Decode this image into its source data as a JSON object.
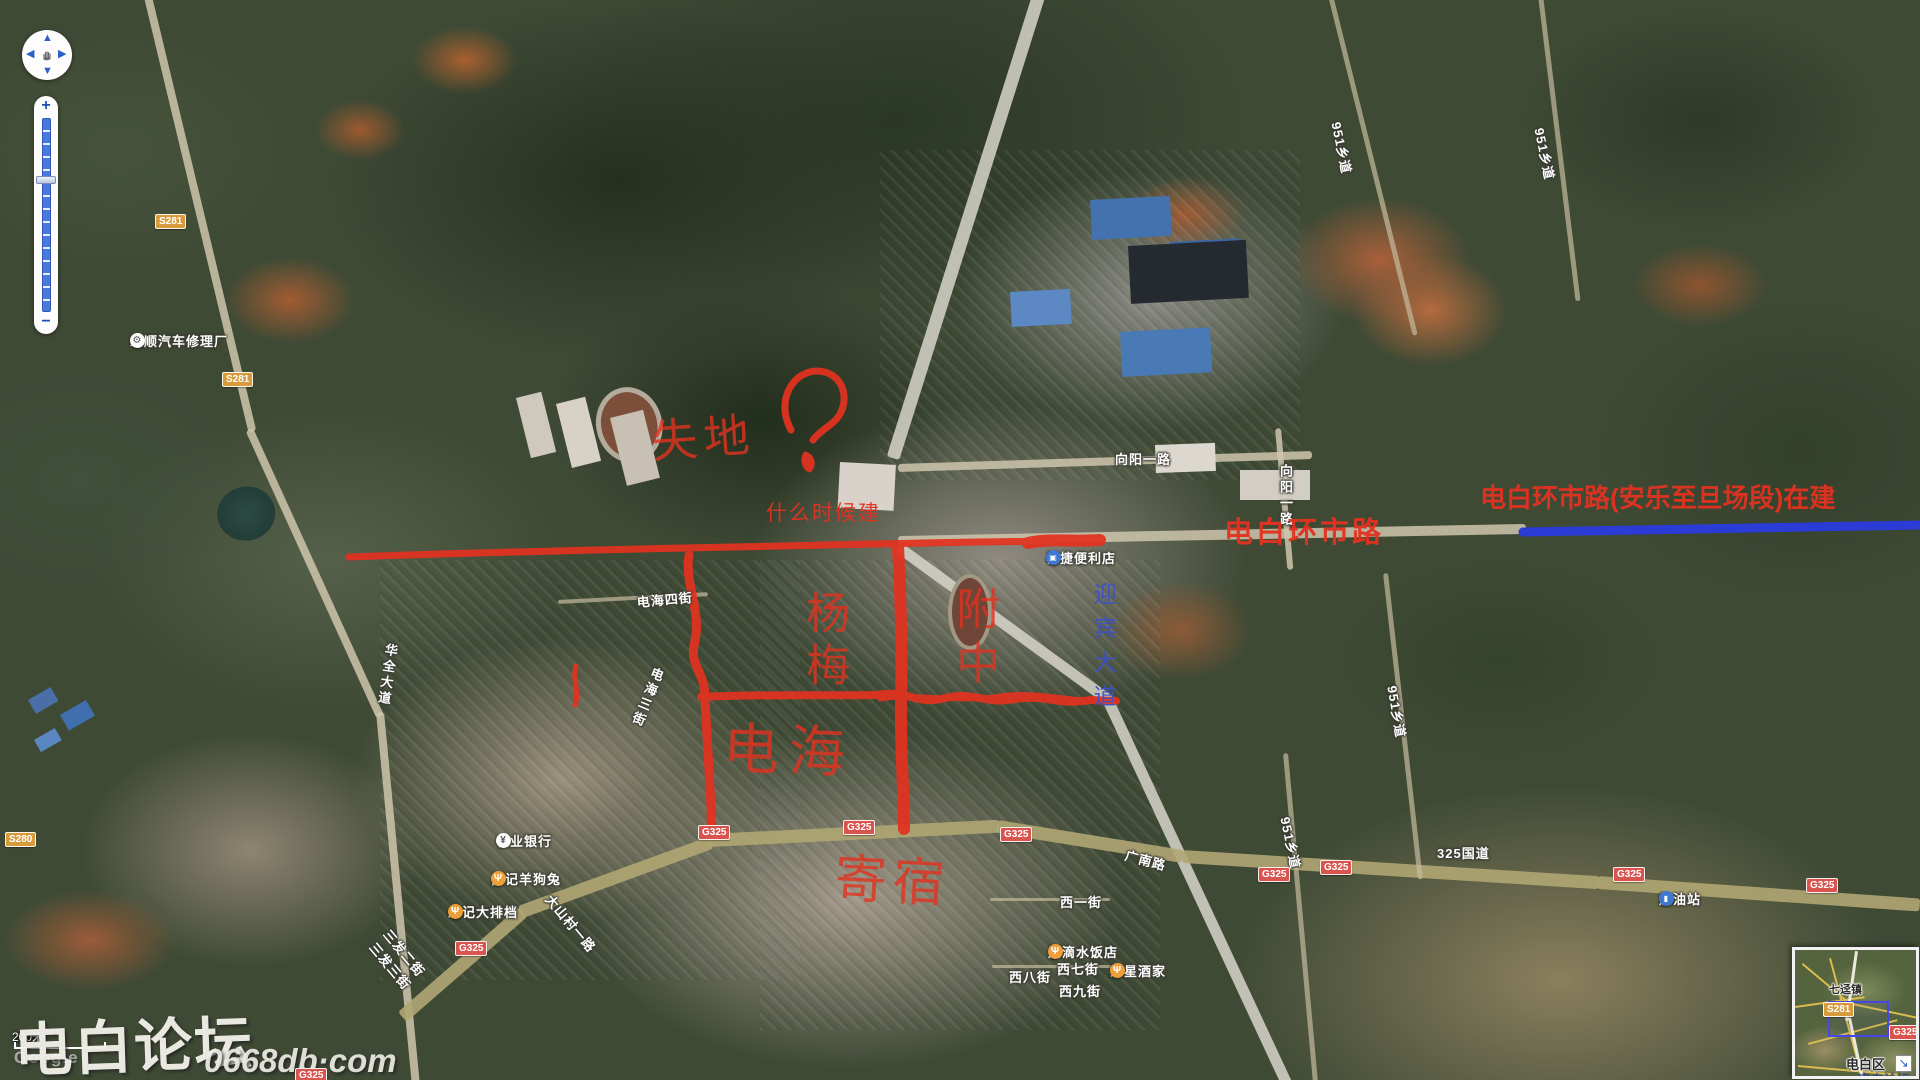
{
  "colors": {
    "annotation_red": "#e33220",
    "annotation_blue": "#2b3bd6",
    "road_label_blue": "#3b52c9",
    "badge_national_bg": "#d9534f",
    "badge_provincial_bg": "#d79b3c"
  },
  "controls": {
    "pan": {
      "up": "▲",
      "down": "▼",
      "left": "◀",
      "right": "▶"
    },
    "zoom_in": "+",
    "zoom_out": "−"
  },
  "scale_bar": {
    "label": "200米"
  },
  "watermark": {
    "brand": "电白论坛",
    "site": "0668db·com"
  },
  "attribution": {
    "google": "Google"
  },
  "icons": {
    "restaurant": "Ψ",
    "bank": "¥",
    "store": "▣",
    "gas": "▮",
    "repair": "⚙"
  },
  "map_labels": [
    {
      "text": "永顺汽车修理厂",
      "x": 130,
      "y": 331,
      "icon": "repair",
      "icon_side": "right"
    },
    {
      "text": "向阳一路",
      "x": 1115,
      "y": 449
    },
    {
      "text": "向阳一路",
      "x": 1276,
      "y": 464,
      "vertical": true
    },
    {
      "text": "电海四街",
      "x": 636,
      "y": 592,
      "rot": -5
    },
    {
      "text": "电海三街",
      "x": 650,
      "y": 664,
      "vertical": true,
      "rot": 22
    },
    {
      "text": "华全大道",
      "x": 382,
      "y": 642,
      "vertical": true,
      "rot": 8
    },
    {
      "text": "易捷便利店",
      "x": 1046,
      "y": 548,
      "icon": "store",
      "icon_side": "right"
    },
    {
      "text": "广南路",
      "x": 1128,
      "y": 845,
      "rot": 15
    },
    {
      "text": "325国道",
      "x": 1437,
      "y": 843
    },
    {
      "text": "加油站",
      "x": 1659,
      "y": 889,
      "icon": "gas",
      "icon_side": "right"
    },
    {
      "text": "农业银行",
      "x": 496,
      "y": 831,
      "icon": "bank",
      "icon_side": "right"
    },
    {
      "text": "昌记羊狗兔",
      "x": 491,
      "y": 869,
      "icon": "restaurant",
      "icon_side": "right"
    },
    {
      "text": "忠记大排档",
      "x": 448,
      "y": 902,
      "icon": "restaurant",
      "icon_side": "right"
    },
    {
      "text": "大山村一路",
      "x": 556,
      "y": 890,
      "rot": 50
    },
    {
      "text": "三发二街",
      "x": 394,
      "y": 925,
      "rot": 50
    },
    {
      "text": "三发三街",
      "x": 380,
      "y": 938,
      "rot": 50
    },
    {
      "text": "西一街",
      "x": 1060,
      "y": 892
    },
    {
      "text": "原滴水饭店",
      "x": 1048,
      "y": 942,
      "icon": "restaurant",
      "icon_side": "right"
    },
    {
      "text": "西七街",
      "x": 1057,
      "y": 959
    },
    {
      "text": "东星酒家",
      "x": 1110,
      "y": 961,
      "icon": "restaurant",
      "icon_side": "left"
    },
    {
      "text": "西八街",
      "x": 1009,
      "y": 967
    },
    {
      "text": "西九街",
      "x": 1059,
      "y": 981
    },
    {
      "text": "951乡道",
      "x": 1346,
      "y": 120,
      "rot": 78
    },
    {
      "text": "951乡道",
      "x": 1549,
      "y": 126,
      "rot": 78
    },
    {
      "text": "951乡道",
      "x": 1402,
      "y": 684,
      "rot": 80
    },
    {
      "text": "951乡道",
      "x": 1295,
      "y": 815,
      "rot": 78
    }
  ],
  "badges": [
    {
      "text": "S281",
      "type": "prov",
      "x": 155,
      "y": 214
    },
    {
      "text": "S281",
      "type": "prov",
      "x": 222,
      "y": 372
    },
    {
      "text": "S280",
      "type": "prov",
      "x": 5,
      "y": 832
    },
    {
      "text": "G325",
      "type": "nat",
      "x": 455,
      "y": 941
    },
    {
      "text": "G325",
      "type": "nat",
      "x": 698,
      "y": 825
    },
    {
      "text": "G325",
      "type": "nat",
      "x": 843,
      "y": 820
    },
    {
      "text": "G325",
      "type": "nat",
      "x": 1000,
      "y": 827
    },
    {
      "text": "G325",
      "type": "nat",
      "x": 1258,
      "y": 867
    },
    {
      "text": "G325",
      "type": "nat",
      "x": 1320,
      "y": 860
    },
    {
      "text": "G325",
      "type": "nat",
      "x": 1613,
      "y": 867
    },
    {
      "text": "G325",
      "type": "nat",
      "x": 1806,
      "y": 878
    },
    {
      "text": "G325",
      "type": "nat",
      "x": 295,
      "y": 1068
    }
  ],
  "annotations": {
    "texts": [
      {
        "name": "note-shidi",
        "text": "失地",
        "x": 650,
        "y": 418,
        "size": 46,
        "ls": 6,
        "rot": -4,
        "hand": true
      },
      {
        "name": "note-when-built",
        "text": "什么时候建",
        "x": 766,
        "y": 503,
        "size": 21,
        "ls": 2
      },
      {
        "name": "note-yangmei",
        "text": "杨梅",
        "x": 800,
        "y": 590,
        "size": 44,
        "ls": 8,
        "vertical": true,
        "hand": true
      },
      {
        "name": "note-fuzhong",
        "text": "附中",
        "x": 950,
        "y": 586,
        "size": 44,
        "ls": 10,
        "vertical": true,
        "hand": true
      },
      {
        "name": "note-dianhai",
        "text": "电海",
        "x": 724,
        "y": 720,
        "size": 56,
        "ls": 10,
        "rot": 2,
        "hand": true
      },
      {
        "name": "note-jisu",
        "text": "寄宿",
        "x": 836,
        "y": 852,
        "size": 52,
        "ls": 6,
        "rot": 3,
        "hand": true
      },
      {
        "name": "note-huanshi-road",
        "text": "电白环市路",
        "x": 1224,
        "y": 518,
        "size": 29,
        "ls": 3,
        "bold": true
      },
      {
        "name": "note-huanshi-inbuild",
        "text": "电白环市路(安乐至旦场段)在建",
        "x": 1480,
        "y": 485,
        "size": 26,
        "bold": true
      },
      {
        "name": "road-label-yingbin-avenue",
        "text": "迎宾大道",
        "x": 1091,
        "y": 582,
        "size": 23,
        "ls": 11,
        "vertical": true,
        "color": "#3b52c9"
      }
    ]
  },
  "minimap": {
    "town": "七迳镇",
    "district": "电白区",
    "badge_s281": "S281",
    "badge_g325": "G325",
    "watermark": "电白论坛",
    "expand_icon": "↘"
  }
}
